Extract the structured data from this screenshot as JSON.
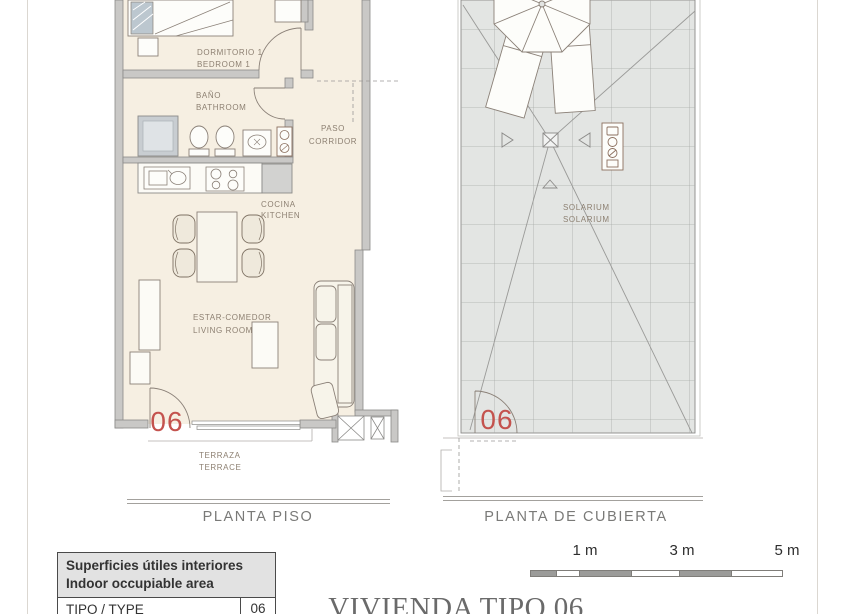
{
  "colors": {
    "accent_red": "#c4534e",
    "wall_gray": "#c9c8c6",
    "floor_cream": "#f6efe2",
    "roof_tile_gray": "#e3e5e3"
  },
  "floor_plan": {
    "name": "PLANTA PISO",
    "unit_number": "06",
    "labels": {
      "bedroom_es": "DORMITORIO 1",
      "bedroom_en": "BEDROOM 1",
      "bathroom_es": "BAÑO",
      "bathroom_en": "BATHROOM",
      "corridor_es": "PASO",
      "corridor_en": "CORRIDOR",
      "kitchen_es": "COCINA",
      "kitchen_en": "KITCHEN",
      "living_es": "ESTAR-COMEDOR",
      "living_en": "LIVING ROOM",
      "terrace_es": "TERRAZA",
      "terrace_en": "TERRACE"
    }
  },
  "roof_plan": {
    "name": "PLANTA DE CUBIERTA",
    "unit_number": "06",
    "labels": {
      "solarium_es": "SOLARIUM",
      "solarium_en": "SOLARIUM"
    }
  },
  "legend_table": {
    "header_es": "Superficies útiles interiores",
    "header_en": "Indoor occupiable area",
    "rows": [
      {
        "label": "TIPO / TYPE",
        "value": "06"
      }
    ]
  },
  "scale_bar": {
    "labels": [
      "1 m",
      "3 m",
      "5 m"
    ]
  },
  "sheet_title": "VIVIENDA TIPO 06"
}
